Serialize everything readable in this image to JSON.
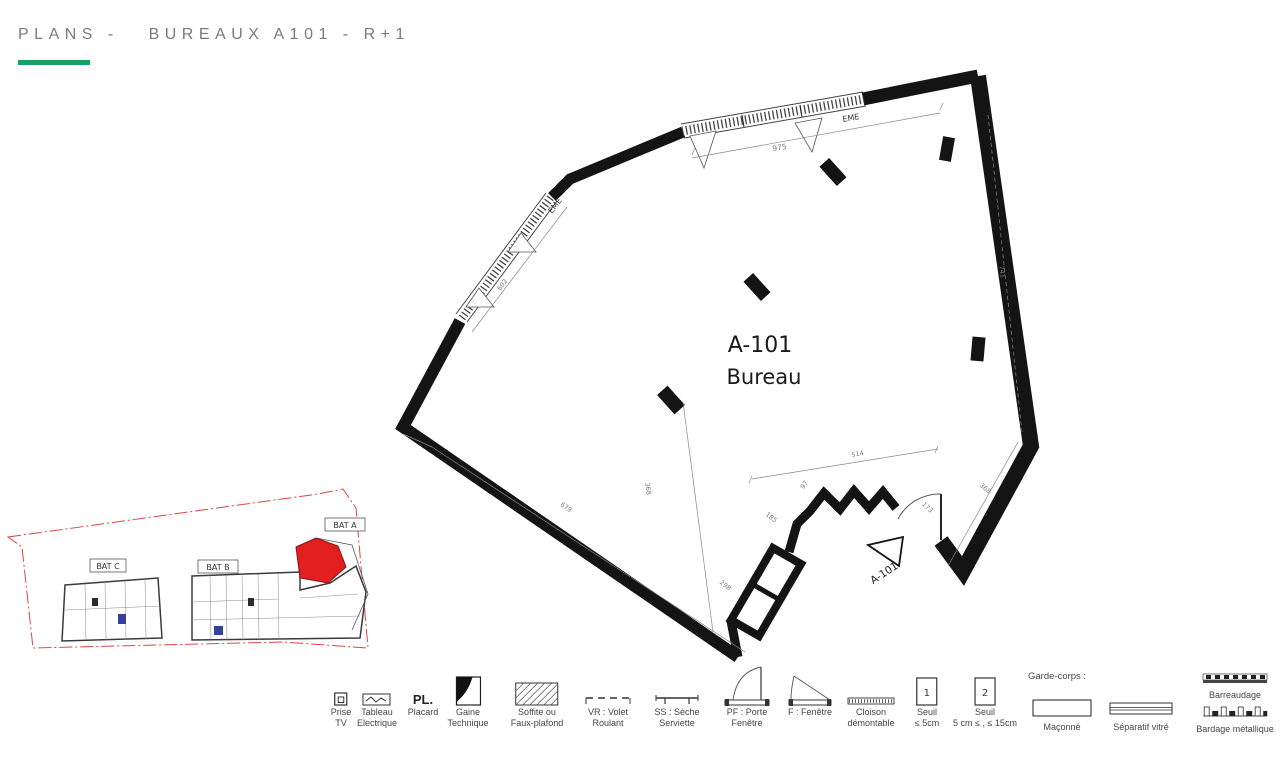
{
  "title": {
    "text": "PLANS -   BUREAUX A101 - R+1"
  },
  "colors": {
    "accent_green": "#15a162",
    "wall": "#141414",
    "unit_red": "#e11f1f",
    "boundary_red": "#e04545"
  },
  "plan": {
    "room_id": "A-101",
    "room_type": "Bureau",
    "entry_marker": "A-101",
    "window_labels": {
      "top": "EME",
      "left": "EME"
    },
    "dimensions": {
      "top": "975",
      "left": "602",
      "right": "741",
      "floor_a": "679",
      "floor_b": "368",
      "d514": "514",
      "d97": "97",
      "d185": "185",
      "d298": "298",
      "door": "173",
      "d368r": "368"
    }
  },
  "siteplan": {
    "bat_a": "BAT A",
    "bat_b": "BAT B",
    "bat_c": "BAT C"
  },
  "legend": {
    "items": [
      {
        "id": "prise-tv",
        "line1": "Prise",
        "line2": "TV"
      },
      {
        "id": "tableau-electrique",
        "line1": "Tableau",
        "line2": "Electrique"
      },
      {
        "id": "placard",
        "icon_text": "PL.",
        "line1": "Placard",
        "line2": ""
      },
      {
        "id": "gaine-technique",
        "line1": "Gaine",
        "line2": "Technique"
      },
      {
        "id": "soffite",
        "line1": "Soffite ou",
        "line2": "Faux-plafond"
      },
      {
        "id": "volet-roulant",
        "line1": "VR : Volet",
        "line2": "Roulant"
      },
      {
        "id": "seche-serviette",
        "line1": "SS : Sèche",
        "line2": "Serviette"
      },
      {
        "id": "porte-fenetre",
        "line1": "PF : Porte",
        "line2": "Fenêtre"
      },
      {
        "id": "fenetre",
        "line1": "F : Fenêtre",
        "line2": ""
      },
      {
        "id": "cloison-demontable",
        "line1": "Cloison",
        "line2": "démontable"
      },
      {
        "id": "seuil-1",
        "box": "1",
        "line1": "Seuil",
        "line2": "≤ 5cm"
      },
      {
        "id": "seuil-2",
        "box": "2",
        "line1": "Seuil",
        "line2": "5 cm ≤ , ≤ 15cm"
      }
    ],
    "garde_corps_title": "Garde-corps :",
    "maconne": "Maçonné",
    "separatif": "Séparatif vitré",
    "barreaudage": "Barreaudage",
    "bardage": "Bardage métallique"
  }
}
